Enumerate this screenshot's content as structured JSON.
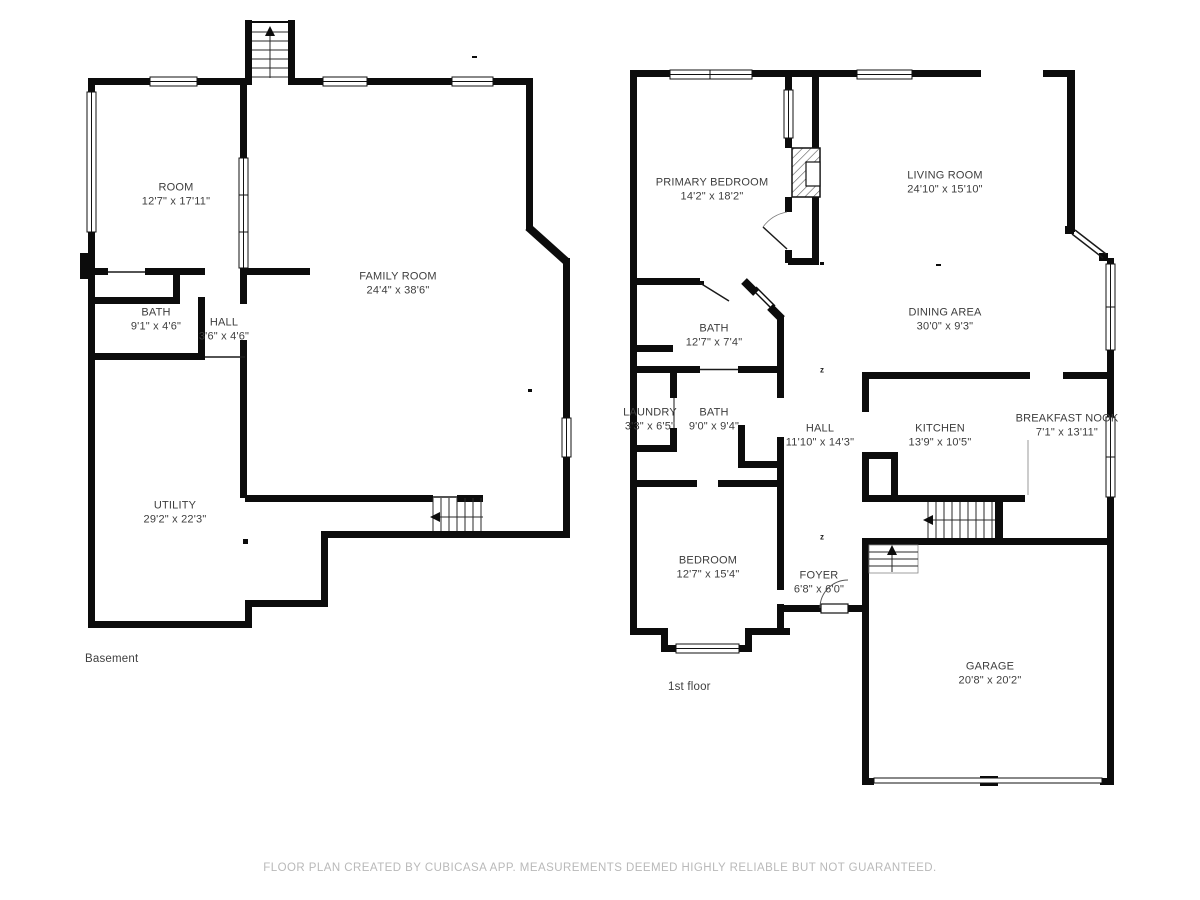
{
  "footer": "FLOOR PLAN CREATED BY CUBICASA APP. MEASUREMENTS DEEMED HIGHLY RELIABLE BUT NOT GUARANTEED.",
  "marks": {
    "sleep": "z"
  },
  "icons": {
    "stairs-up-arrow": "black triangle pointing up",
    "stairs-left-arrow": "black triangle pointing left",
    "door-swing": "thin quarter-circle arc",
    "window": "white bar with thin black outline set into wall",
    "fireplace": "diagonally hatched box"
  },
  "colors": {
    "background": "#ffffff",
    "wall": "#0c0c0c",
    "room_label": "#3d3d3d",
    "floor_label": "#3f3f3f",
    "footer_text": "#b9b9b9"
  },
  "floors": [
    {
      "label": "Basement",
      "rooms": [
        {
          "name": "ROOM",
          "dims": "12'7\" x 17'11\""
        },
        {
          "name": "FAMILY ROOM",
          "dims": "24'4\" x 38'6\""
        },
        {
          "name": "BATH",
          "dims": "9'1\" x 4'6\""
        },
        {
          "name": "HALL",
          "dims": "3'6\" x 4'6\""
        },
        {
          "name": "UTILITY",
          "dims": "29'2\" x 22'3\""
        }
      ]
    },
    {
      "label": "1st floor",
      "rooms": [
        {
          "name": "PRIMARY BEDROOM",
          "dims": "14'2\" x 18'2\""
        },
        {
          "name": "LIVING ROOM",
          "dims": "24'10\" x 15'10\""
        },
        {
          "name": "BATH",
          "dims": "12'7\" x 7'4\""
        },
        {
          "name": "DINING AREA",
          "dims": "30'0\" x 9'3\""
        },
        {
          "name": "LAUNDRY",
          "dims": "3'3\" x 6'5\""
        },
        {
          "name": "BATH",
          "dims": "9'0\" x 9'4\""
        },
        {
          "name": "HALL",
          "dims": "11'10\" x 14'3\""
        },
        {
          "name": "KITCHEN",
          "dims": "13'9\" x 10'5\""
        },
        {
          "name": "BREAKFAST NOOK",
          "dims": "7'1\" x 13'11\""
        },
        {
          "name": "BEDROOM",
          "dims": "12'7\" x 15'4\""
        },
        {
          "name": "FOYER",
          "dims": "6'8\" x 6'0\""
        },
        {
          "name": "GARAGE",
          "dims": "20'8\" x 20'2\""
        }
      ]
    }
  ]
}
